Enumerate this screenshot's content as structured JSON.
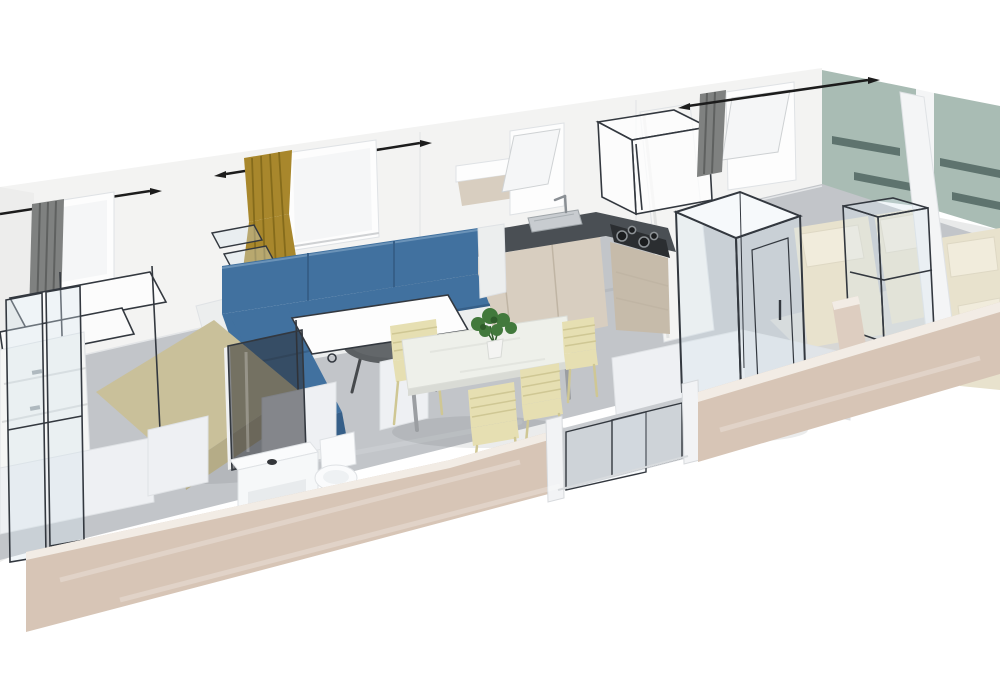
{
  "scene": {
    "type": "3d-isometric-cutaway-render",
    "subject": "mobile home / holiday lodge interior floor plan",
    "rooms": [
      "master-bedroom",
      "bathroom",
      "living-room",
      "kitchen",
      "hallway-with-shower-cubicle",
      "bedroom-twin-1",
      "bedroom-twin-2"
    ],
    "objects": [
      "curtain-rods-with-arrow-finials",
      "gray-curtains",
      "gold-curtain",
      "tilt-open-windows",
      "blue-corner-sofa",
      "round-coffee-table",
      "dining-table",
      "four-cream-slatted-chairs",
      "potted-plant",
      "l-shaped-kitchen-counter",
      "stainless-sink-with-faucet",
      "gas-hob",
      "wireframe-range-hood",
      "tall-white-column",
      "wall-shelf",
      "khaki-double-bed",
      "white-dresser",
      "wireframe-fold-down-bunk",
      "glass-shower-panels",
      "smoked-glass-shower-door",
      "vanity-with-basin",
      "toilet",
      "transparent-shower-cubicle",
      "sage-green-headboard-walls-with-shelves",
      "cream-single-beds-with-pillows",
      "wireframe-wardrobes",
      "beige-front-wall",
      "sliding-glass-door"
    ]
  },
  "palette": {
    "background": "#ffffff",
    "wall_white": "#f3f3f2",
    "wall_white_shade": "#e9eaea",
    "wall_left_end": "#ededec",
    "wall_green": "#a9bcb4",
    "shelf_green": "#5e736e",
    "divider_white": "#f4f5f6",
    "floor_gray": "#c2c5c9",
    "floor_door": "#c9ccd0",
    "floor_streak_light": "#ced1d4",
    "floor_streak_dark": "#b3b6ba",
    "floor_bedroom": "#d7d7d5",
    "front_wall_beige": "#d7c5b6",
    "front_wall_top_rail": "#f2ece5",
    "interior_wall_beige": "#ddcdc0",
    "sofa_blue": "#41719f",
    "sofa_blue_dark": "#365f88",
    "sofa_blue_light": "#6b93b8",
    "sofa_base_white": "#eceeee",
    "bed_khaki": "#c9c09a",
    "bed_khaki_dark": "#b5ac87",
    "bed_cream": "#e8e2cd",
    "pillow_cream": "#f1ecdc",
    "curtain_gold": "#a8872c",
    "curtain_gold_dark": "#7c6418",
    "curtain_gray": "#7f8180",
    "curtain_gray_dark": "#5f6160",
    "rod_black": "#1c1c1c",
    "counter_dark": "#4a4f54",
    "cabinet_wood": "#d8cec0",
    "cabinet_wood_dark": "#c6bbaa",
    "cabinet_seam": "#c0b5a4",
    "cabinet_white": "#f1f1ef",
    "column_white": "#f4f4f3",
    "table_top": "#eef0ea",
    "table_edge": "#d9dbd5",
    "table_leg_gray": "#9b9ea2",
    "chair_cream": "#e6dfb2",
    "chair_cream_dark": "#cfc794",
    "coffee_table_gray": "#5b5f62",
    "coffee_table_leg": "#46494c",
    "stove_black": "#2b2e31",
    "burner_gray": "#8d9296",
    "sink_steel": "#c8ccd0",
    "faucet_gray": "#8a8f94",
    "plant_green": "#42793c",
    "plant_green_dark": "#2f5c2b",
    "pot_white": "#f4f4f2",
    "porcelain_white": "#fafbfc",
    "partition_white": "#eef0f3",
    "partition_shade": "#e0e4e8",
    "glass_fill": "rgba(215,228,238,0.35)",
    "glass_dark": "rgba(45,48,52,0.55)",
    "wireframe": "#33383f",
    "window_white": "#fdfdfd",
    "window_glass": "#f5f6f7",
    "shadow": "rgba(60,65,70,0.10)"
  }
}
